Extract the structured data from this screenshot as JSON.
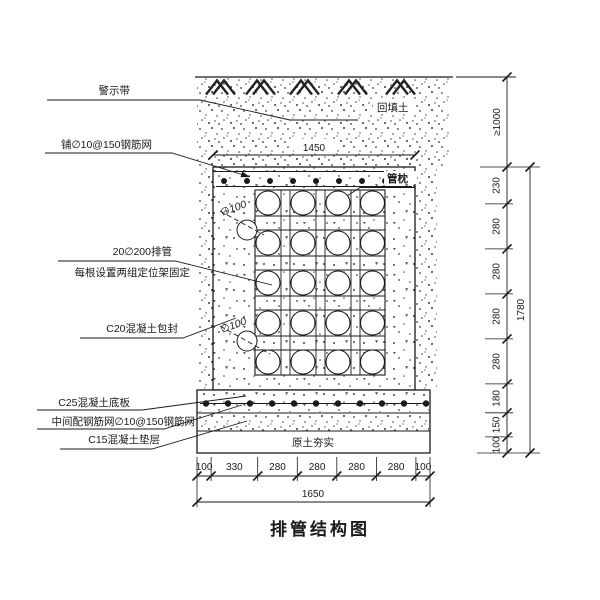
{
  "title": "排管结构图",
  "callouts": {
    "warning_tape": "警示带",
    "top_mesh": "铺∅10@150钢筋网",
    "pipe_bank_line1": "20∅200排管",
    "pipe_bank_line2": "每根设置两组定位架固定",
    "c20_encasement": "C20混凝土包封",
    "c25_base_slab": "C25混凝土底板",
    "mid_mesh": "中间配钢筋网∅10@150钢筋网",
    "c15_cushion": "C15混凝土垫层"
  },
  "annotations": {
    "backfill": "回填土",
    "pipe_pillow": "管枕",
    "compacted_soil": "原土夯实",
    "drain_dia_1": "∅100",
    "drain_dia_2": "∅100"
  },
  "dimensions": {
    "top_width": "1450",
    "bottom_segments": [
      "100",
      "330",
      "280",
      "280",
      "280",
      "280",
      "100"
    ],
    "bottom_total": "1650",
    "right_cover": "≥1000",
    "right_segments": [
      "230",
      "280",
      "280",
      "280",
      "280",
      "180",
      "150",
      "100"
    ],
    "right_total": "1780"
  },
  "drawing": {
    "pipe_rows": 5,
    "pipe_cols": 4
  },
  "colors": {
    "line": "#1a1a1a",
    "background": "#ffffff"
  }
}
